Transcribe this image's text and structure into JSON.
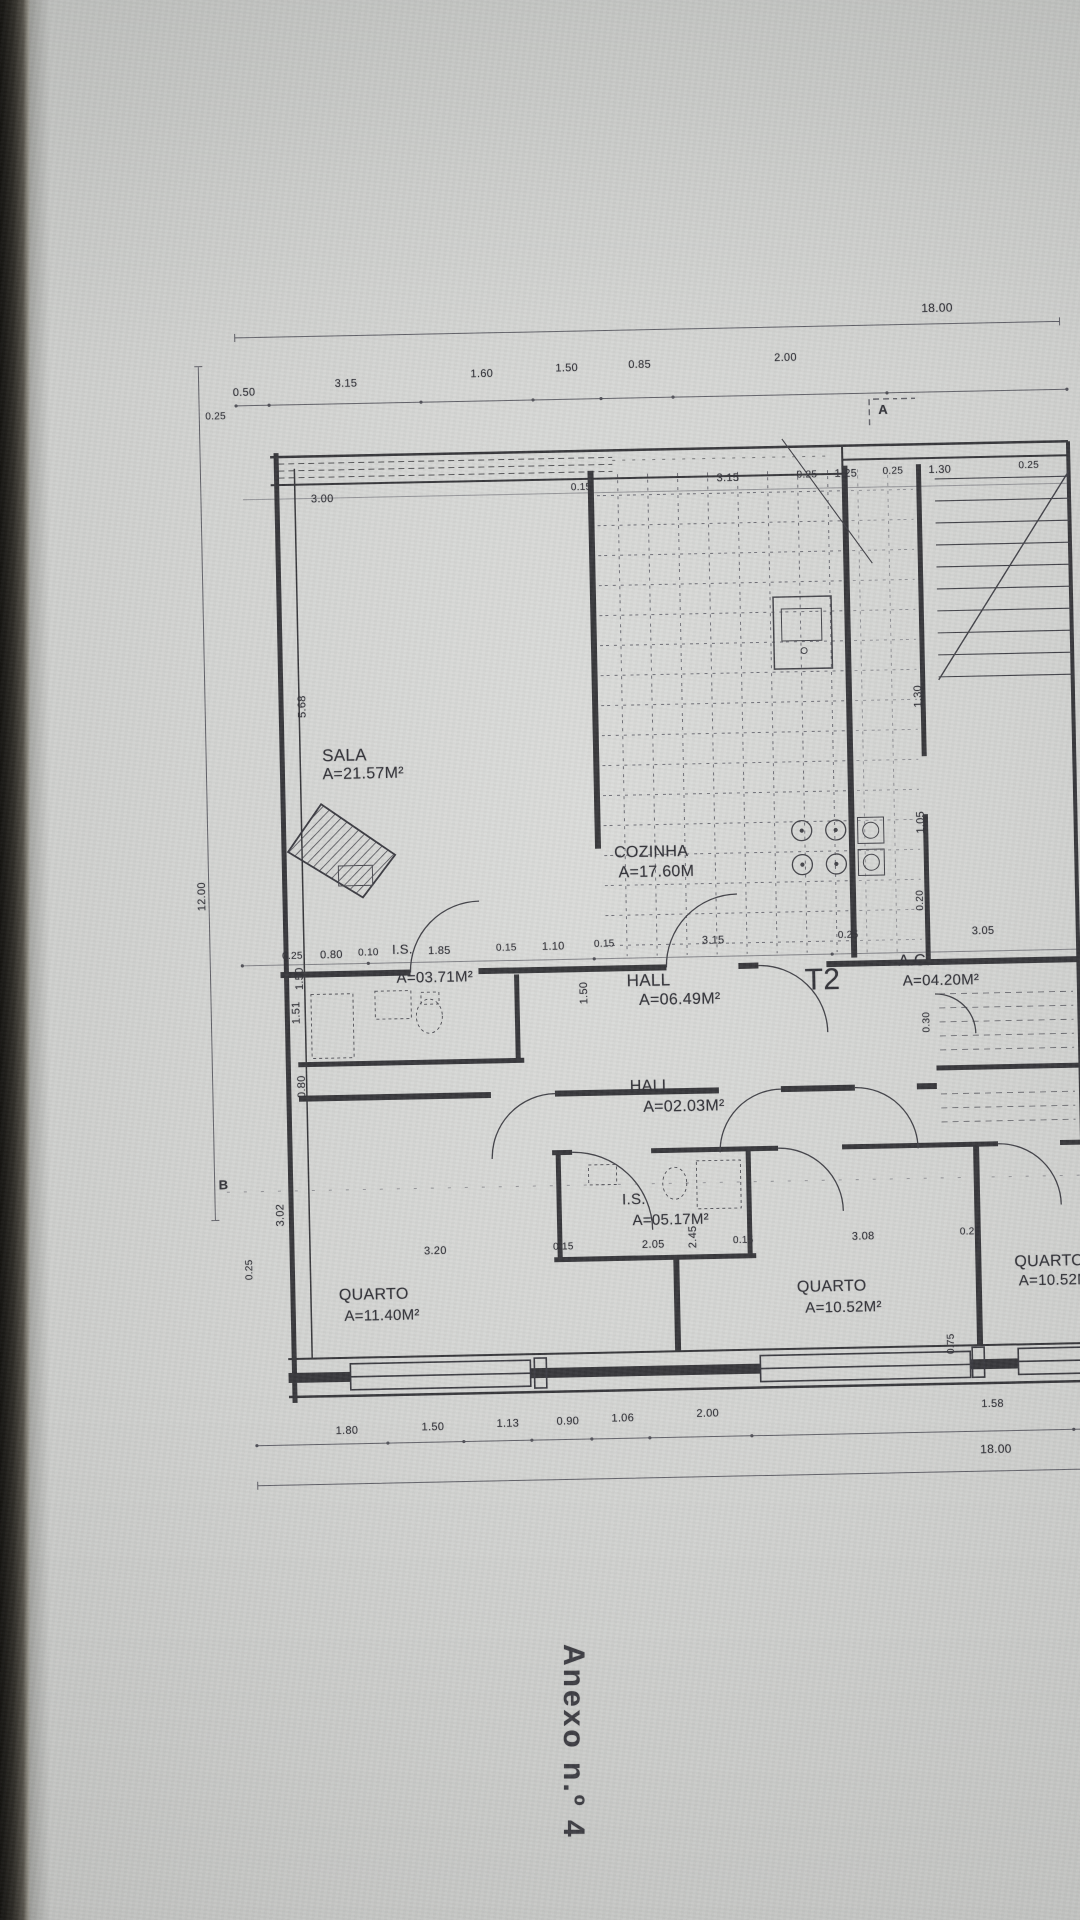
{
  "annex": {
    "text": "Anexo n.º 4"
  },
  "colors": {
    "paper": "#d3d4d2",
    "ink": "#2f2f33",
    "backing": "#141310"
  },
  "plan": {
    "unit_label": {
      "id": "unit-type-t2",
      "text": "T2",
      "x": 612,
      "y": 668,
      "s": 30
    },
    "rooms": [
      {
        "id": "sala",
        "name": "SALA",
        "area": "A=21.57M²",
        "nx": 134,
        "ny": 441,
        "ax": 134,
        "ay": 461,
        "ns": 17,
        "as": 16
      },
      {
        "id": "cozinha",
        "name": "COZINHA",
        "area": "A=17.60M",
        "nx": 424,
        "ny": 545,
        "ax": 428,
        "ay": 565,
        "ns": 16,
        "as": 16
      },
      {
        "id": "is1",
        "name": "I.S.",
        "area": "A=03.71M²",
        "nx": 200,
        "ny": 638,
        "ax": 204,
        "ay": 666,
        "ns": 13,
        "as": 15
      },
      {
        "id": "hall1",
        "name": "HALL",
        "area": "A=06.49M²",
        "nx": 434,
        "ny": 672,
        "ax": 446,
        "ay": 693,
        "ns": 17,
        "as": 16
      },
      {
        "id": "ac",
        "name": "A.C.",
        "area": "A=04.20M²",
        "nx": 706,
        "ny": 659,
        "ax": 710,
        "ay": 679,
        "ns": 16,
        "as": 15
      },
      {
        "id": "hall2",
        "name": "HALL",
        "area": "A=02.03M²",
        "nx": 435,
        "ny": 779,
        "ax": 448,
        "ay": 800,
        "ns": 16,
        "as": 16
      },
      {
        "id": "is2",
        "name": "I.S.",
        "area": "A=05.17M²",
        "nx": 425,
        "ny": 892,
        "ax": 435,
        "ay": 913,
        "ns": 15,
        "as": 15
      },
      {
        "id": "quarto1",
        "name": "QUARTO",
        "area": "A=11.40M²",
        "nx": 140,
        "ny": 982,
        "ax": 145,
        "ay": 1003,
        "ns": 16,
        "as": 15
      },
      {
        "id": "quarto2",
        "name": "QUARTO",
        "area": "A=10.52M²",
        "nx": 598,
        "ny": 983,
        "ax": 606,
        "ay": 1004,
        "ns": 16,
        "as": 15
      },
      {
        "id": "quarto3",
        "name": "QUARTO",
        "area": "A=10.52M²",
        "nx": 816,
        "ny": 962,
        "ax": 820,
        "ay": 981,
        "ns": 16,
        "as": 15
      }
    ],
    "labels": [
      {
        "id": "dim-top-total",
        "text": "18.00",
        "x": 742,
        "y": 8,
        "s": 12
      },
      {
        "id": "dim-top-1",
        "text": "0.50",
        "x": 52,
        "y": 80
      },
      {
        "id": "dim-top-2",
        "text": "3.15",
        "x": 154,
        "y": 73
      },
      {
        "id": "dim-top-3",
        "text": "1.60",
        "x": 290,
        "y": 66
      },
      {
        "id": "dim-top-4",
        "text": "1.50",
        "x": 375,
        "y": 62
      },
      {
        "id": "dim-top-5",
        "text": "0.85",
        "x": 448,
        "y": 60
      },
      {
        "id": "dim-top-6",
        "text": "2.00",
        "x": 594,
        "y": 56
      },
      {
        "id": "section-marker-a",
        "text": "A",
        "x": 697,
        "y": 108,
        "s": 13,
        "b": 1
      },
      {
        "id": "dim-upper-left",
        "text": "0.25",
        "x": 24,
        "y": 104,
        "s": 10
      },
      {
        "id": "dim-upper-1",
        "text": "3.00",
        "x": 128,
        "y": 188
      },
      {
        "id": "dim-upper-2",
        "text": "0.15",
        "x": 388,
        "y": 182,
        "s": 10
      },
      {
        "id": "dim-upper-3",
        "text": "3.15",
        "x": 534,
        "y": 175
      },
      {
        "id": "dim-upper-4",
        "text": "0.25",
        "x": 614,
        "y": 174,
        "s": 10
      },
      {
        "id": "dim-upper-5",
        "text": "1.25",
        "x": 652,
        "y": 173
      },
      {
        "id": "dim-upper-6",
        "text": "0.25",
        "x": 700,
        "y": 172,
        "s": 10
      },
      {
        "id": "dim-upper-7",
        "text": "1.30",
        "x": 746,
        "y": 171
      },
      {
        "id": "dim-upper-8",
        "text": "0.25",
        "x": 836,
        "y": 169,
        "s": 10
      },
      {
        "id": "dim-left-1200",
        "text": "12.00",
        "x": 12,
        "y": 588,
        "rot": 1
      },
      {
        "id": "dim-left-568",
        "text": "5.68",
        "x": 116,
        "y": 400,
        "rot": 1
      },
      {
        "id": "dim-left-150",
        "text": "1.50",
        "x": 108,
        "y": 672,
        "rot": 1
      },
      {
        "id": "dim-left-151",
        "text": "1.51",
        "x": 104,
        "y": 706,
        "rot": 1
      },
      {
        "id": "dim-left-080",
        "text": "0.80",
        "x": 108,
        "y": 780,
        "rot": 1
      },
      {
        "id": "dim-left-302",
        "text": "3.02",
        "x": 84,
        "y": 908,
        "rot": 1
      },
      {
        "id": "dim-left-025",
        "text": "0.25",
        "x": 52,
        "y": 962,
        "rot": 1,
        "s": 10
      },
      {
        "id": "section-marker-b",
        "text": "B",
        "x": 22,
        "y": 870,
        "s": 13,
        "b": 1
      },
      {
        "id": "dim-mid-1",
        "text": "0.25",
        "x": 90,
        "y": 645,
        "s": 10
      },
      {
        "id": "dim-mid-2",
        "text": "0.80",
        "x": 128,
        "y": 644
      },
      {
        "id": "dim-mid-3",
        "text": "0.10",
        "x": 166,
        "y": 643,
        "s": 10
      },
      {
        "id": "dim-mid-4",
        "text": "1.85",
        "x": 236,
        "y": 642
      },
      {
        "id": "dim-mid-5",
        "text": "0.15",
        "x": 304,
        "y": 641,
        "s": 10
      },
      {
        "id": "dim-mid-6",
        "text": "1.10",
        "x": 350,
        "y": 640
      },
      {
        "id": "dim-mid-7",
        "text": "0.15",
        "x": 402,
        "y": 639,
        "s": 10
      },
      {
        "id": "dim-mid-8",
        "text": "3.15",
        "x": 510,
        "y": 637
      },
      {
        "id": "dim-mid-9",
        "text": "0.25",
        "x": 646,
        "y": 635,
        "s": 10
      },
      {
        "id": "dim-mid-10",
        "text": "3.05",
        "x": 780,
        "y": 633
      },
      {
        "id": "dim-v-150",
        "text": "1.50",
        "x": 392,
        "y": 692,
        "rot": 1
      },
      {
        "id": "dim-v-030",
        "text": "0.30",
        "x": 734,
        "y": 728,
        "rot": 1,
        "s": 10
      },
      {
        "id": "dim-v-245",
        "text": "2.45",
        "x": 496,
        "y": 938,
        "rot": 1
      },
      {
        "id": "dim-right-130",
        "text": "1.30",
        "x": 732,
        "y": 402,
        "rot": 1
      },
      {
        "id": "dim-right-105",
        "text": "1.05",
        "x": 732,
        "y": 528,
        "rot": 1
      },
      {
        "id": "dim-right-020",
        "text": "0.20",
        "x": 730,
        "y": 606,
        "rot": 1,
        "s": 10
      },
      {
        "id": "dim-right-075",
        "text": "0.75",
        "x": 752,
        "y": 1050,
        "rot": 1,
        "s": 10
      },
      {
        "id": "dim-low-1",
        "text": "3.20",
        "x": 226,
        "y": 942
      },
      {
        "id": "dim-low-2",
        "text": "0.15",
        "x": 355,
        "y": 941,
        "s": 10
      },
      {
        "id": "dim-low-3",
        "text": "2.05",
        "x": 444,
        "y": 940
      },
      {
        "id": "dim-low-4",
        "text": "0.15",
        "x": 535,
        "y": 938,
        "s": 10
      },
      {
        "id": "dim-low-5",
        "text": "3.08",
        "x": 654,
        "y": 936
      },
      {
        "id": "dim-low-6",
        "text": "0.25",
        "x": 762,
        "y": 934,
        "s": 10
      },
      {
        "id": "dim-bot-1",
        "text": "1.80",
        "x": 134,
        "y": 1120
      },
      {
        "id": "dim-bot-2",
        "text": "1.50",
        "x": 220,
        "y": 1118
      },
      {
        "id": "dim-bot-3",
        "text": "1.13",
        "x": 295,
        "y": 1116
      },
      {
        "id": "dim-bot-4",
        "text": "0.90",
        "x": 355,
        "y": 1115
      },
      {
        "id": "dim-bot-5",
        "text": "1.06",
        "x": 410,
        "y": 1113
      },
      {
        "id": "dim-bot-6",
        "text": "2.00",
        "x": 495,
        "y": 1110
      },
      {
        "id": "dim-bot-7",
        "text": "1.58",
        "x": 780,
        "y": 1106
      },
      {
        "id": "dim-bot-total",
        "text": "18.00",
        "x": 778,
        "y": 1150,
        "s": 12
      }
    ]
  }
}
